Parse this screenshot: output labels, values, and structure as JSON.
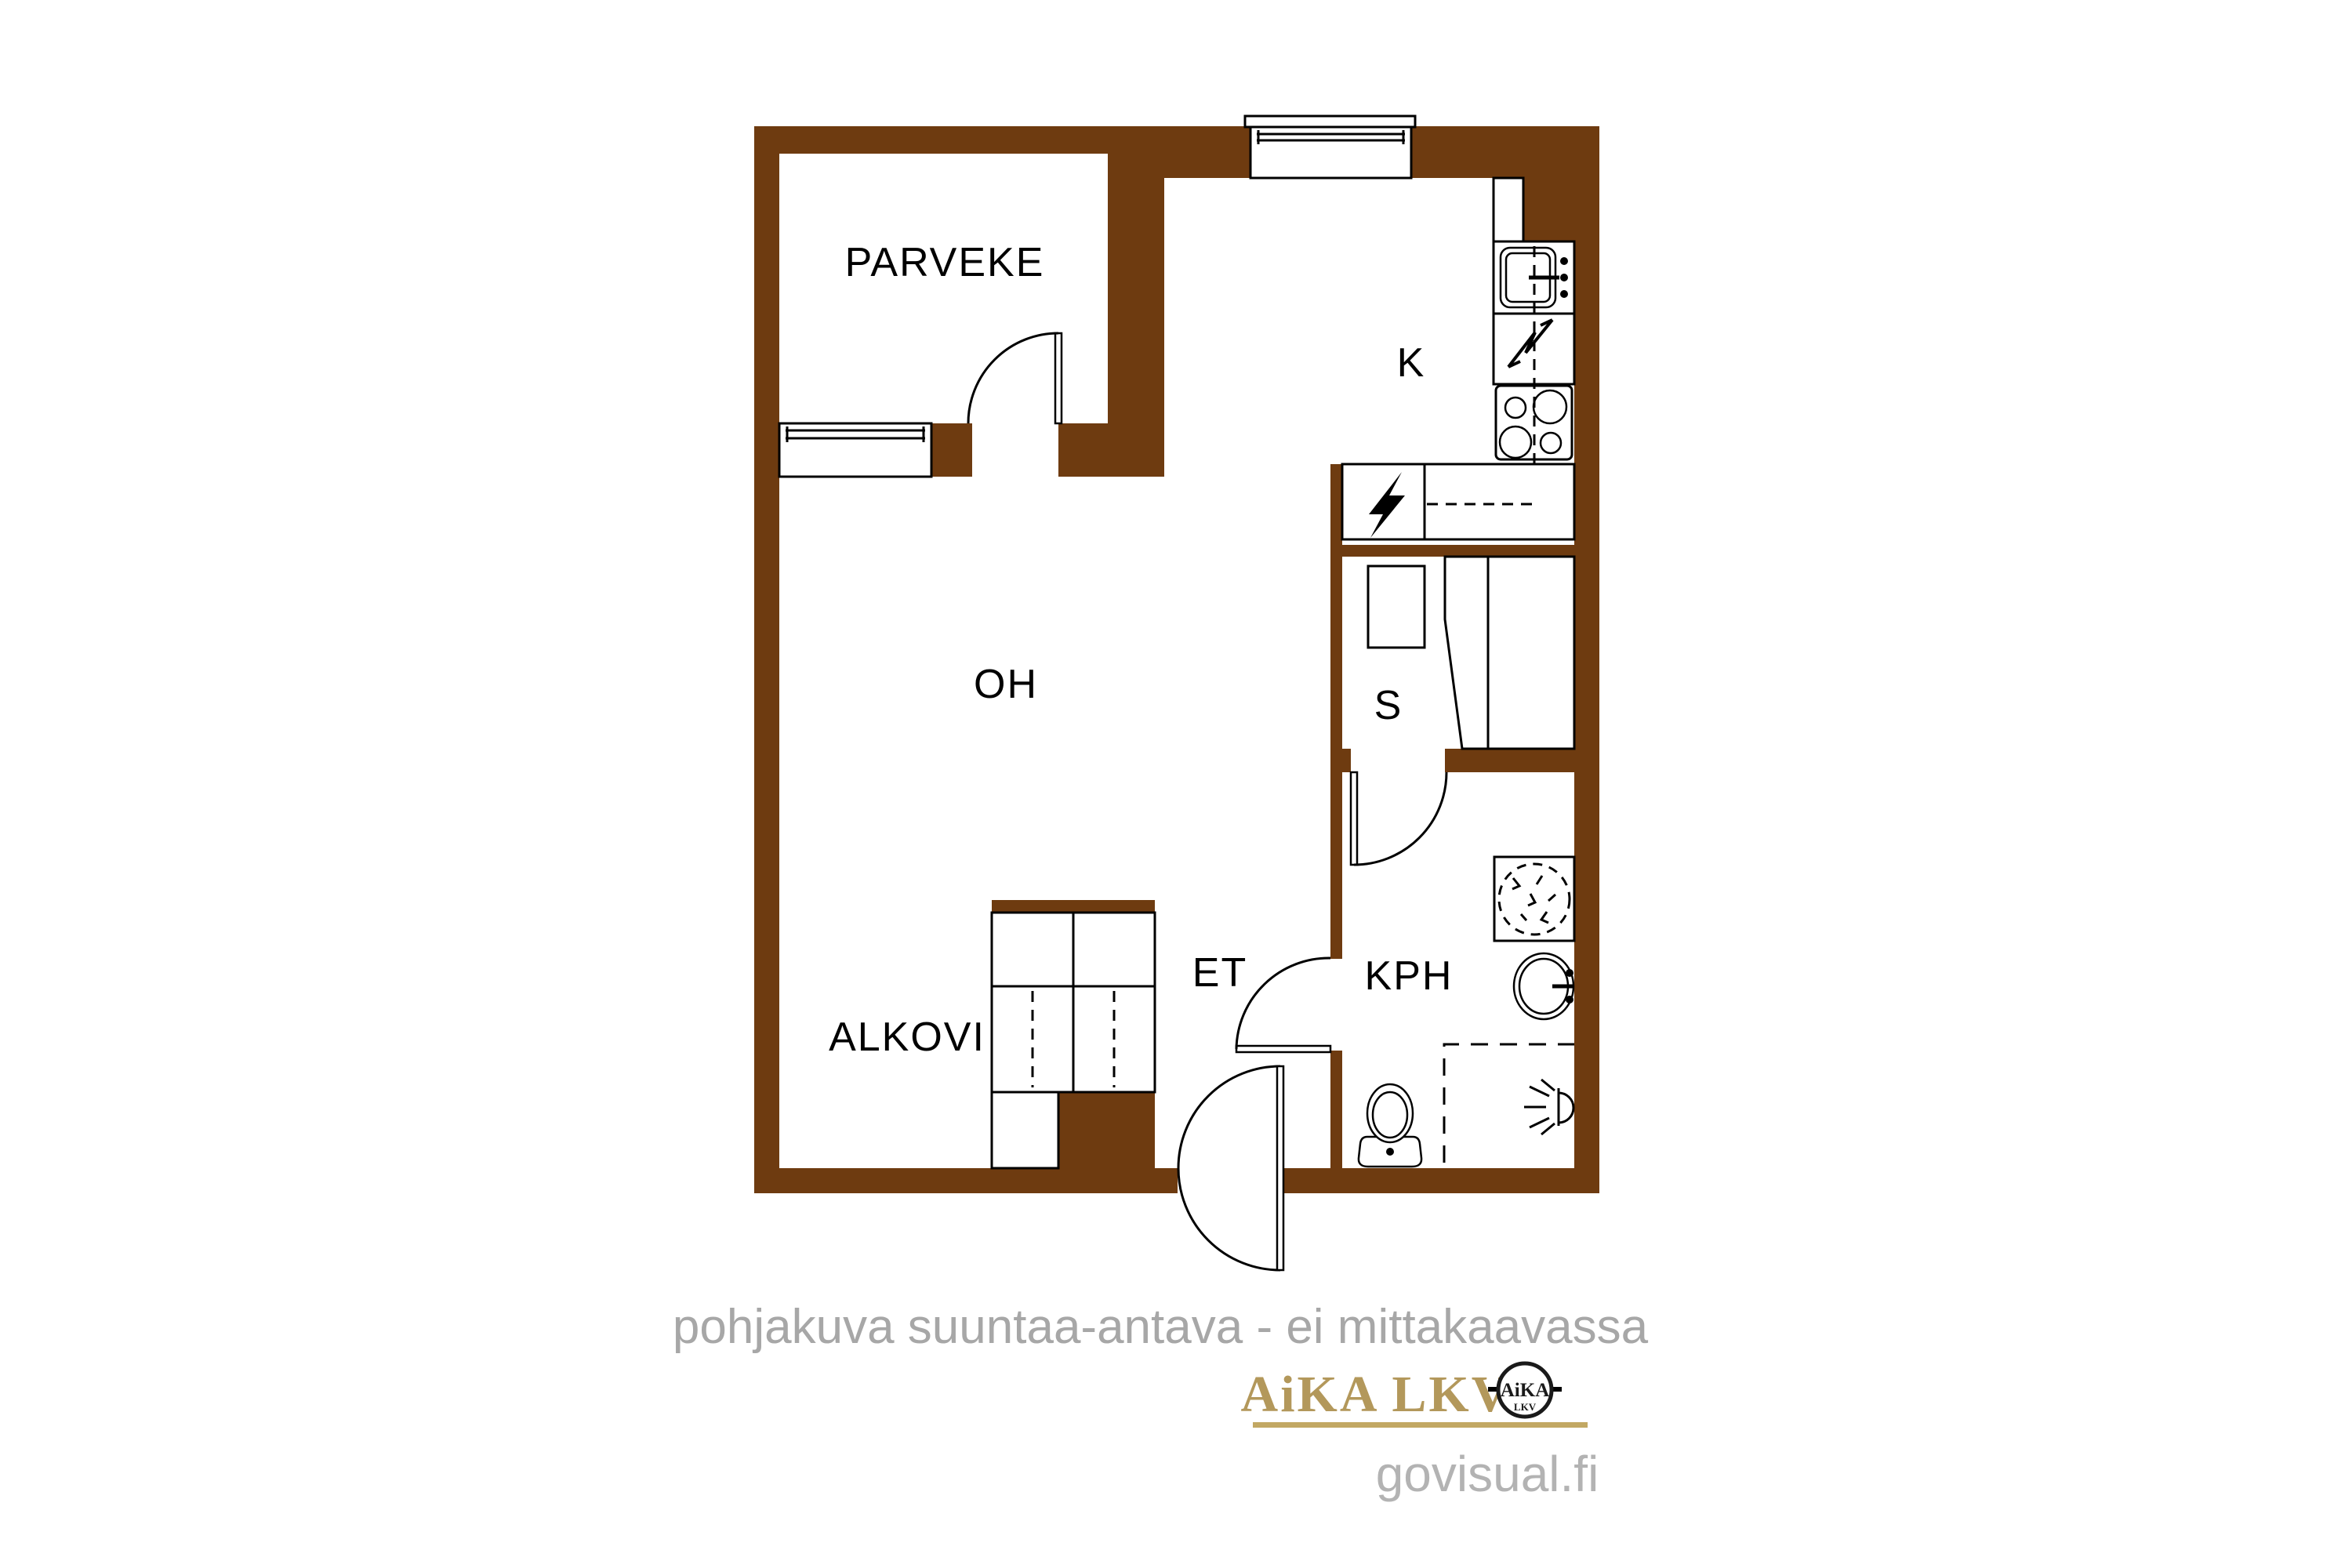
{
  "plan": {
    "wall_color": "#6E3B10",
    "line_color": "#000000",
    "label_color": "#000000",
    "rooms": [
      {
        "id": "parveke",
        "label": "PARVEKE"
      },
      {
        "id": "k",
        "label": "K"
      },
      {
        "id": "oh",
        "label": "OH"
      },
      {
        "id": "s",
        "label": "S"
      },
      {
        "id": "et",
        "label": "ET"
      },
      {
        "id": "kph",
        "label": "KPH"
      },
      {
        "id": "alkovi",
        "label": "ALKOVI"
      }
    ],
    "icons": [
      "balcony-window-icon",
      "balcony-door-icon",
      "kitchen-window-icon",
      "tall-cabinet-icon",
      "kitchen-sink-icon",
      "appliance-reservation-icon",
      "stove-icon",
      "electrical-panel-icon",
      "kitchen-counter",
      "sauna-heater-icon",
      "sauna-bench-icon",
      "sauna-door-icon",
      "washing-machine-icon",
      "bathroom-sink-icon",
      "shower-icon",
      "toilet-icon",
      "bathroom-door-icon",
      "entry-door-icon",
      "wardrobe-icon",
      "cabinet-icon"
    ]
  },
  "footer": {
    "disclaimer": "pohjakuva suuntaa-antava - ei mittakaavassa",
    "disclaimer_color": "#A7A7A7",
    "brand": "AiKA LKV",
    "brand_color": "#B3985B",
    "underline_color": "#C2A863",
    "logo_top": "AiKA",
    "logo_bottom": "LKV",
    "website": "govisual.fi",
    "website_color": "#B3B3B3"
  }
}
